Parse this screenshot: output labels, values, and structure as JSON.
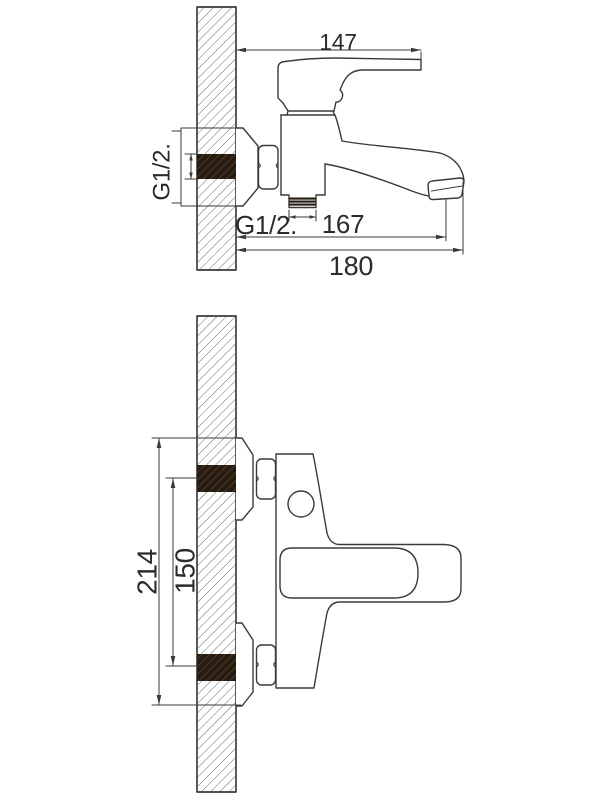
{
  "drawing": {
    "side_view": {
      "labels": {
        "handle_projection": "147",
        "wall_connection_thread": "G1/2.",
        "bottom_outlet_thread": "G1/2.",
        "spout_reach": "167",
        "overall_projection": "180"
      }
    },
    "plan_view": {
      "labels": {
        "overall_body_span": "214",
        "connection_centre_distance": "150"
      }
    },
    "colors": {
      "line": "#3a3a3a",
      "text": "#2b2b2b",
      "thread_block": "#261b11",
      "background": "#ffffff"
    }
  }
}
